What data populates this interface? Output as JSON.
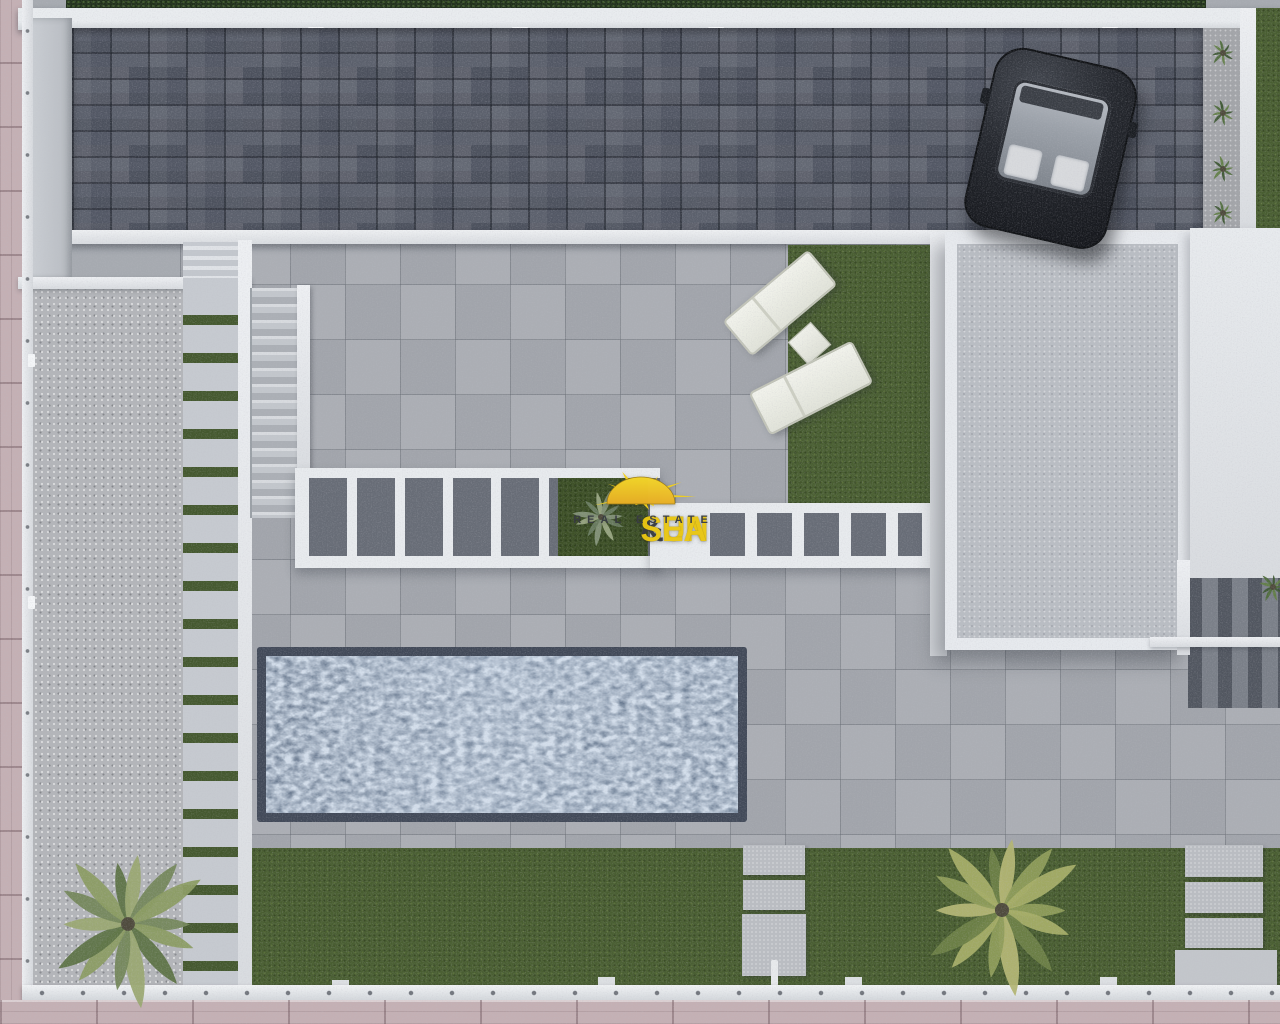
{
  "watermark": {
    "brand_word1": "SUN ",
    "brand_amp": "&",
    "brand_word2": " SEA",
    "tagline": "REAL ESTATE"
  },
  "palette": {
    "driveway": "#525764",
    "terrace": "#a6aab0",
    "pool_border": "#414958",
    "lawn": "#495e31",
    "grass_strip": "#44582e",
    "gravel": "#b3b5b9",
    "sidewalk": "#c4b0b4",
    "hedge": "#20301a",
    "shade": "#676c76",
    "roof_gray": "#b9bdc3",
    "logo_yellow": "#e9c613",
    "logo_dark": "#383c42",
    "sun_yellow": "#f2d01e",
    "sun_orange": "#eaaf25"
  }
}
